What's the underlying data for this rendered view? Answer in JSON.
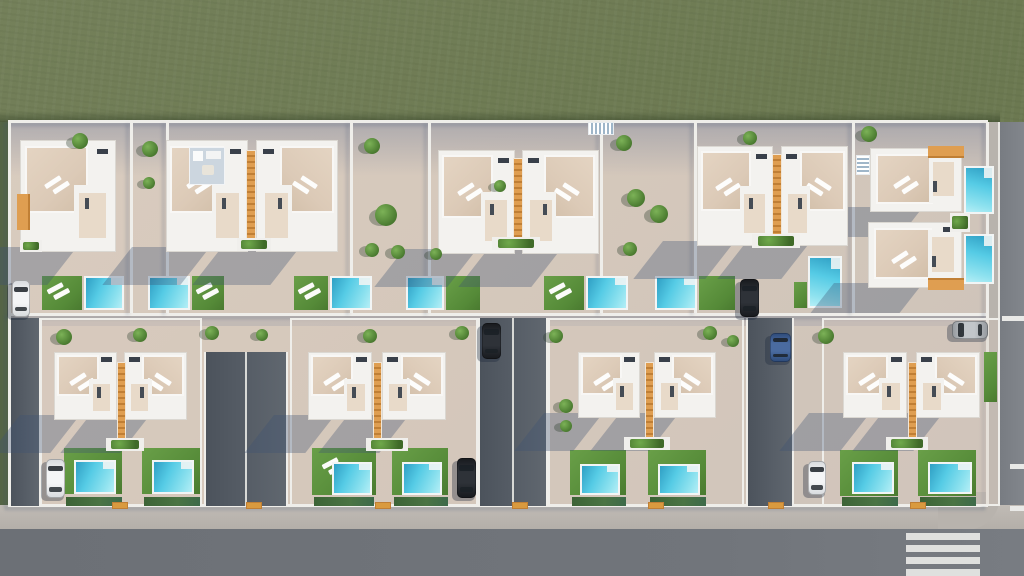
{
  "meta": {
    "kind": "aerial-architectural-render",
    "width": 1024,
    "height": 576
  },
  "palette": {
    "grass": "#6d7a52",
    "grassLight": "#76815a",
    "grassDark": "#5968443",
    "grassShade": "rgba(20,35,15,0.25)",
    "pave": "#d5c8bb",
    "paveWarm": "#dccdbf",
    "shadow": "rgba(62,83,116,0.33)",
    "shadowSoft": "rgba(80,100,140,0.28)",
    "white": "#f3f2ef",
    "wall": "#efeeea",
    "roof": "#dccab7",
    "roofLight": "#e8dac9",
    "deck": "#ccd6df",
    "orange": "#df9e51",
    "orangeDark": "#c07f35",
    "gate": "#d99a3f",
    "poolDeep": "#2f9fc4",
    "pool": "#55cbe5",
    "poolLight": "#9ce9f3",
    "lawn": "#5d9440",
    "lawnDark": "#49772f",
    "hedge": "#41683a",
    "drive": "#575e67",
    "driveDark": "#4c535c",
    "road": "#71757b",
    "roadLight": "#7d8187",
    "sidewalk": "#b8b3ad",
    "curb": "#e9e7e2",
    "carWhite": "#e9ebec",
    "carBlack": "#23262b",
    "carBlue": "#3d5c8f",
    "carSilver": "#aeb3b8",
    "glass": "#1a2026",
    "foliage": "#4e7f33",
    "foliageLight": "#7cb257"
  },
  "ground": {
    "grass": {
      "x": 0,
      "y": 0,
      "w": 1024,
      "h": 576
    },
    "grassEdgeShadow": {
      "x": 0,
      "y": 111,
      "w": 1000,
      "h": 11
    },
    "leftGrassStrip": {
      "x": 0,
      "y": 122,
      "w": 9,
      "h": 386
    },
    "site": {
      "x": 8,
      "y": 122,
      "w": 980,
      "h": 386
    }
  },
  "tints": [
    {
      "x": 8,
      "y": 122,
      "w": 980,
      "h": 54,
      "kind": "top-band"
    },
    {
      "x": 8,
      "y": 316,
      "w": 980,
      "h": 10,
      "kind": "mid-band"
    }
  ],
  "roads": {
    "bottomSidewalk": {
      "x": 0,
      "y": 505,
      "w": 1024,
      "h": 26
    },
    "bottomRoad": {
      "x": 0,
      "y": 529,
      "w": 1024,
      "h": 47
    },
    "rightRoad": {
      "x": 998,
      "y": 122,
      "w": 26,
      "h": 412
    },
    "rightSidewalk": {
      "x": 988,
      "y": 122,
      "w": 11,
      "h": 386
    },
    "cornerSidewalk": {
      "x": 938,
      "y": 492,
      "w": 62,
      "h": 38
    },
    "crosswalk": {
      "x": 906,
      "y": 533,
      "w": 74,
      "stripeH": 7,
      "gap": 5,
      "count": 4
    },
    "laneDashes": [
      {
        "x": 1002,
        "y": 316,
        "w": 22,
        "h": 5
      },
      {
        "x": 1010,
        "y": 464,
        "w": 14,
        "h": 5
      },
      {
        "x": 1010,
        "y": 506,
        "w": 14,
        "h": 5
      }
    ]
  },
  "walls": {
    "horizontal": [
      {
        "x": 8,
        "y": 120,
        "w": 980,
        "h": 3
      },
      {
        "x": 8,
        "y": 313,
        "w": 980,
        "h": 3
      },
      {
        "x": 8,
        "y": 504,
        "w": 980,
        "h": 3
      }
    ],
    "vertical": [
      {
        "x": 8,
        "y": 122,
        "h": 384
      },
      {
        "x": 130,
        "y": 122,
        "h": 191
      },
      {
        "x": 166,
        "y": 122,
        "h": 191
      },
      {
        "x": 350,
        "y": 122,
        "h": 191
      },
      {
        "x": 428,
        "y": 122,
        "h": 191
      },
      {
        "x": 600,
        "y": 122,
        "h": 191
      },
      {
        "x": 694,
        "y": 122,
        "h": 191
      },
      {
        "x": 852,
        "y": 122,
        "h": 191
      },
      {
        "x": 986,
        "y": 122,
        "h": 384
      }
    ]
  },
  "plots": [
    {
      "x": 40,
      "y": 318,
      "w": 162,
      "h": 188
    },
    {
      "x": 290,
      "y": 318,
      "w": 188,
      "h": 188
    },
    {
      "x": 548,
      "y": 318,
      "w": 196,
      "h": 188
    },
    {
      "x": 822,
      "y": 318,
      "w": 178,
      "h": 188
    }
  ],
  "streets": [
    {
      "x": 9,
      "y": 318,
      "w": 32,
      "h": 188
    },
    {
      "x": 204,
      "y": 352,
      "w": 84,
      "h": 154,
      "divider": 245
    },
    {
      "x": 478,
      "y": 318,
      "w": 70,
      "h": 188,
      "divider": 512
    },
    {
      "x": 746,
      "y": 318,
      "w": 48,
      "h": 188
    }
  ],
  "villas": [
    {
      "x": 20,
      "y": 140,
      "w": 96,
      "h": 112,
      "orange": "left"
    },
    {
      "x": 166,
      "y": 140,
      "w": 82,
      "h": 112,
      "deck": true
    },
    {
      "x": 256,
      "y": 140,
      "w": 82,
      "h": 112,
      "mirror": true
    },
    {
      "x": 438,
      "y": 150,
      "w": 77,
      "h": 104
    },
    {
      "x": 522,
      "y": 150,
      "w": 77,
      "h": 104,
      "mirror": true
    },
    {
      "x": 697,
      "y": 146,
      "w": 76,
      "h": 100
    },
    {
      "x": 781,
      "y": 146,
      "w": 67,
      "h": 100,
      "mirror": true
    },
    {
      "x": 870,
      "y": 148,
      "w": 92,
      "h": 64,
      "rotated": true,
      "orange": "tr"
    },
    {
      "x": 868,
      "y": 222,
      "w": 94,
      "h": 66,
      "rotated": true,
      "orange": "br"
    },
    {
      "x": 54,
      "y": 352,
      "w": 63,
      "h": 68
    },
    {
      "x": 124,
      "y": 352,
      "w": 63,
      "h": 68,
      "mirror": true
    },
    {
      "x": 308,
      "y": 352,
      "w": 64,
      "h": 68
    },
    {
      "x": 382,
      "y": 352,
      "w": 64,
      "h": 68,
      "mirror": true
    },
    {
      "x": 578,
      "y": 352,
      "w": 62,
      "h": 66
    },
    {
      "x": 654,
      "y": 352,
      "w": 62,
      "h": 66,
      "mirror": true
    },
    {
      "x": 843,
      "y": 352,
      "w": 64,
      "h": 66
    },
    {
      "x": 916,
      "y": 352,
      "w": 64,
      "h": 66,
      "mirror": true
    }
  ],
  "dividers": [
    {
      "x": 246,
      "y": 150,
      "w": 10,
      "h": 96
    },
    {
      "x": 513,
      "y": 158,
      "w": 10,
      "h": 88
    },
    {
      "x": 772,
      "y": 154,
      "w": 10,
      "h": 86
    },
    {
      "x": 117,
      "y": 362,
      "w": 9,
      "h": 78
    },
    {
      "x": 373,
      "y": 362,
      "w": 9,
      "h": 78
    },
    {
      "x": 645,
      "y": 362,
      "w": 9,
      "h": 76
    },
    {
      "x": 908,
      "y": 362,
      "w": 9,
      "h": 76
    }
  ],
  "lawns": [
    {
      "x": 42,
      "y": 276,
      "w": 40,
      "h": 34,
      "l": true
    },
    {
      "x": 192,
      "y": 276,
      "w": 32,
      "h": 34,
      "l": true
    },
    {
      "x": 294,
      "y": 276,
      "w": 34,
      "h": 34,
      "l": true
    },
    {
      "x": 446,
      "y": 276,
      "w": 34,
      "h": 34
    },
    {
      "x": 544,
      "y": 276,
      "w": 40,
      "h": 34,
      "l": true
    },
    {
      "x": 699,
      "y": 276,
      "w": 36,
      "h": 34
    },
    {
      "x": 794,
      "y": 282,
      "w": 13,
      "h": 26
    },
    {
      "x": 64,
      "y": 448,
      "w": 58,
      "h": 46
    },
    {
      "x": 142,
      "y": 448,
      "w": 58,
      "h": 46
    },
    {
      "x": 312,
      "y": 448,
      "w": 64,
      "h": 47,
      "l": true
    },
    {
      "x": 392,
      "y": 448,
      "w": 56,
      "h": 47
    },
    {
      "x": 570,
      "y": 450,
      "w": 56,
      "h": 45
    },
    {
      "x": 648,
      "y": 450,
      "w": 58,
      "h": 45
    },
    {
      "x": 840,
      "y": 450,
      "w": 58,
      "h": 46
    },
    {
      "x": 918,
      "y": 450,
      "w": 58,
      "h": 46
    },
    {
      "x": 984,
      "y": 352,
      "w": 13,
      "h": 50
    }
  ],
  "pools": [
    {
      "x": 84,
      "y": 276,
      "w": 40,
      "h": 34
    },
    {
      "x": 148,
      "y": 276,
      "w": 42,
      "h": 34
    },
    {
      "x": 330,
      "y": 276,
      "w": 42,
      "h": 34
    },
    {
      "x": 406,
      "y": 276,
      "w": 38,
      "h": 34
    },
    {
      "x": 586,
      "y": 276,
      "w": 42,
      "h": 34
    },
    {
      "x": 655,
      "y": 276,
      "w": 42,
      "h": 34
    },
    {
      "x": 808,
      "y": 256,
      "w": 34,
      "h": 52,
      "v": true
    },
    {
      "x": 964,
      "y": 166,
      "w": 30,
      "h": 48,
      "v": true
    },
    {
      "x": 964,
      "y": 234,
      "w": 30,
      "h": 50,
      "v": true
    },
    {
      "x": 74,
      "y": 460,
      "w": 42,
      "h": 34
    },
    {
      "x": 152,
      "y": 460,
      "w": 42,
      "h": 34
    },
    {
      "x": 332,
      "y": 462,
      "w": 40,
      "h": 33
    },
    {
      "x": 402,
      "y": 462,
      "w": 40,
      "h": 33
    },
    {
      "x": 580,
      "y": 464,
      "w": 40,
      "h": 31
    },
    {
      "x": 658,
      "y": 464,
      "w": 42,
      "h": 31
    },
    {
      "x": 852,
      "y": 462,
      "w": 42,
      "h": 32
    },
    {
      "x": 928,
      "y": 462,
      "w": 44,
      "h": 32
    }
  ],
  "hedges": [
    {
      "x": 66,
      "y": 497,
      "w": 56,
      "h": 9
    },
    {
      "x": 144,
      "y": 497,
      "w": 56,
      "h": 9
    },
    {
      "x": 314,
      "y": 497,
      "w": 60,
      "h": 9
    },
    {
      "x": 394,
      "y": 497,
      "w": 54,
      "h": 9
    },
    {
      "x": 572,
      "y": 497,
      "w": 54,
      "h": 9
    },
    {
      "x": 650,
      "y": 497,
      "w": 56,
      "h": 9
    },
    {
      "x": 842,
      "y": 497,
      "w": 56,
      "h": 9
    },
    {
      "x": 920,
      "y": 497,
      "w": 56,
      "h": 9
    }
  ],
  "planters": [
    {
      "x": 20,
      "y": 240,
      "w": 22,
      "h": 12
    },
    {
      "x": 237,
      "y": 238,
      "w": 34,
      "h": 13
    },
    {
      "x": 492,
      "y": 237,
      "w": 48,
      "h": 13
    },
    {
      "x": 752,
      "y": 234,
      "w": 48,
      "h": 14
    },
    {
      "x": 950,
      "y": 213,
      "w": 20,
      "h": 19
    },
    {
      "x": 106,
      "y": 438,
      "w": 38,
      "h": 13
    },
    {
      "x": 366,
      "y": 438,
      "w": 42,
      "h": 13
    },
    {
      "x": 624,
      "y": 437,
      "w": 46,
      "h": 13
    },
    {
      "x": 886,
      "y": 437,
      "w": 42,
      "h": 13
    }
  ],
  "stairs": [
    {
      "x": 588,
      "y": 122,
      "w": 26,
      "h": 13
    },
    {
      "x": 856,
      "y": 155,
      "w": 14,
      "h": 20,
      "v": true
    }
  ],
  "trees": [
    {
      "x": 80,
      "y": 141,
      "r": 8
    },
    {
      "x": 150,
      "y": 149,
      "r": 8
    },
    {
      "x": 149,
      "y": 183,
      "r": 6
    },
    {
      "x": 372,
      "y": 146,
      "r": 8
    },
    {
      "x": 386,
      "y": 215,
      "r": 11
    },
    {
      "x": 372,
      "y": 250,
      "r": 7
    },
    {
      "x": 398,
      "y": 252,
      "r": 7
    },
    {
      "x": 624,
      "y": 143,
      "r": 8
    },
    {
      "x": 636,
      "y": 198,
      "r": 9
    },
    {
      "x": 659,
      "y": 214,
      "r": 9
    },
    {
      "x": 630,
      "y": 249,
      "r": 7
    },
    {
      "x": 750,
      "y": 138,
      "r": 7
    },
    {
      "x": 869,
      "y": 134,
      "r": 8
    },
    {
      "x": 64,
      "y": 337,
      "r": 8
    },
    {
      "x": 140,
      "y": 335,
      "r": 7
    },
    {
      "x": 212,
      "y": 333,
      "r": 7
    },
    {
      "x": 262,
      "y": 335,
      "r": 6
    },
    {
      "x": 370,
      "y": 336,
      "r": 7
    },
    {
      "x": 462,
      "y": 333,
      "r": 7
    },
    {
      "x": 556,
      "y": 336,
      "r": 7
    },
    {
      "x": 710,
      "y": 333,
      "r": 7
    },
    {
      "x": 733,
      "y": 341,
      "r": 6
    },
    {
      "x": 826,
      "y": 336,
      "r": 8
    },
    {
      "x": 566,
      "y": 406,
      "r": 7
    },
    {
      "x": 566,
      "y": 426,
      "r": 6
    },
    {
      "x": 500,
      "y": 186,
      "r": 6
    },
    {
      "x": 436,
      "y": 254,
      "r": 6
    }
  ],
  "gates": [
    {
      "x": 112,
      "y": 502,
      "w": 16,
      "h": 7
    },
    {
      "x": 246,
      "y": 502,
      "w": 16,
      "h": 7
    },
    {
      "x": 375,
      "y": 502,
      "w": 16,
      "h": 7
    },
    {
      "x": 512,
      "y": 502,
      "w": 16,
      "h": 7
    },
    {
      "x": 648,
      "y": 502,
      "w": 16,
      "h": 7
    },
    {
      "x": 768,
      "y": 502,
      "w": 16,
      "h": 7
    },
    {
      "x": 910,
      "y": 502,
      "w": 16,
      "h": 7
    }
  ],
  "cars": [
    {
      "x": 12,
      "y": 280,
      "w": 18,
      "h": 37,
      "c": "white",
      "dir": "v"
    },
    {
      "x": 482,
      "y": 323,
      "w": 19,
      "h": 36,
      "c": "black",
      "dir": "v"
    },
    {
      "x": 740,
      "y": 279,
      "w": 19,
      "h": 38,
      "c": "black",
      "dir": "v"
    },
    {
      "x": 952,
      "y": 321,
      "w": 36,
      "h": 18,
      "c": "silver",
      "dir": "h"
    },
    {
      "x": 46,
      "y": 459,
      "w": 19,
      "h": 39,
      "c": "white",
      "dir": "v"
    },
    {
      "x": 457,
      "y": 458,
      "w": 19,
      "h": 40,
      "c": "black",
      "dir": "v"
    },
    {
      "x": 770,
      "y": 333,
      "w": 21,
      "h": 29,
      "c": "blue",
      "dir": "v"
    },
    {
      "x": 808,
      "y": 461,
      "w": 18,
      "h": 34,
      "c": "white",
      "dir": "v"
    }
  ]
}
